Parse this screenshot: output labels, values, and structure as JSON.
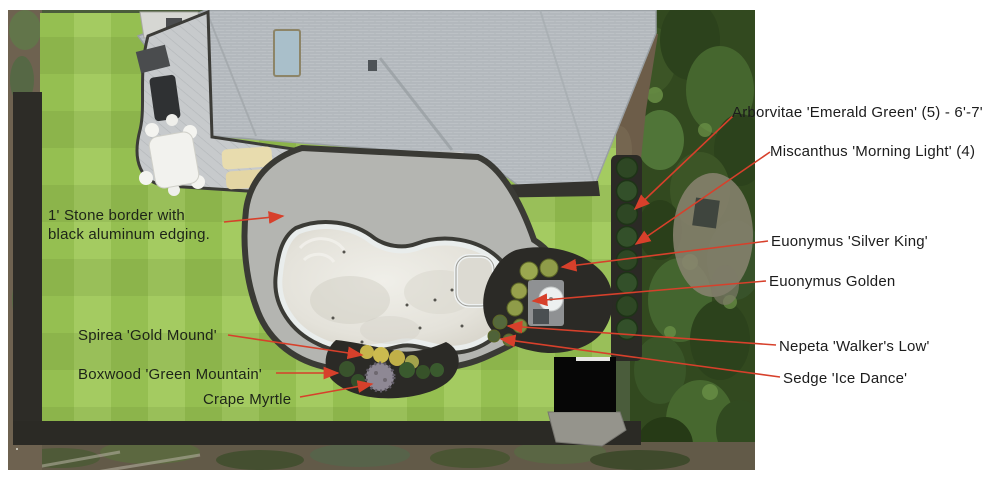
{
  "plan": {
    "callouts_right": [
      "Arborvitae 'Emerald Green' (5) - 6'-7'",
      "Miscanthus 'Morning Light' (4)",
      "Euonymus 'Silver King'",
      "Euonymus Golden",
      "Nepeta 'Walker's Low'",
      "Sedge 'Ice Dance'"
    ],
    "callouts_left": {
      "stone_border_line1": "1' Stone border with",
      "stone_border_line2": "black aluminum edging.",
      "spirea": "Spirea 'Gold Mound'",
      "boxwood": "Boxwood 'Green Mountain'",
      "crape_myrtle": "Crape Myrtle"
    },
    "colors": {
      "annotation_red": "#d7402b",
      "label_text": "#1c1c1c",
      "lawn_green_light": "#a4cb61",
      "lawn_green_dark": "#95bf51",
      "mulch_dark": "#2b2a26",
      "patio_gray": "#b4b5b1",
      "pool_interior": "#e6e4dd",
      "roof_gray": "#bcc1c5",
      "tree_green": "#32491f"
    }
  }
}
